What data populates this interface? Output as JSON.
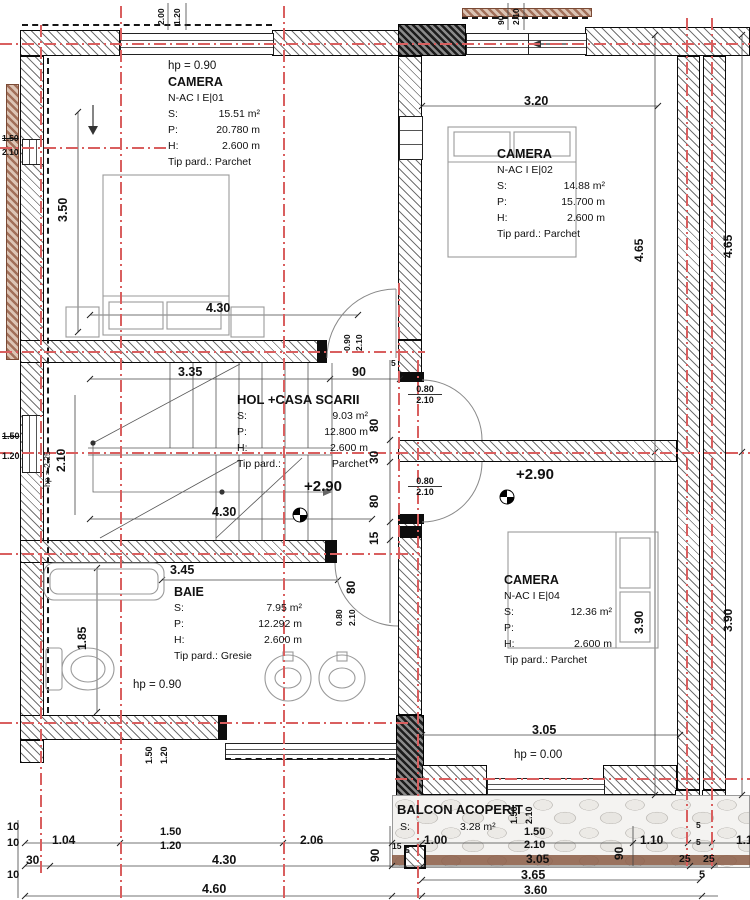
{
  "rooms": {
    "camera1": {
      "hp": "hp = 0.90",
      "name": "CAMERA",
      "code": "N-AC I E|01",
      "s_label": "S:",
      "s": "15.51 m²",
      "p_label": "P:",
      "p": "20.780 m",
      "h_label": "H:",
      "h": "2.600 m",
      "floor": "Tip pard.: Parchet"
    },
    "camera2": {
      "name": "CAMERA",
      "code": "N-AC I E|02",
      "s_label": "S:",
      "s": "14.88 m²",
      "p_label": "P:",
      "p": "15.700 m",
      "h_label": "H:",
      "h": "2.600 m",
      "floor": "Tip pard.: Parchet"
    },
    "hol": {
      "name": "HOL +CASA SCARII",
      "s_label": "S:",
      "s": "9.03 m²",
      "p_label": "P:",
      "p": "12.800 m",
      "h_label": "H:",
      "h": "2.600 m",
      "tip_label": "Tip pard.:",
      "floor": "Parchet",
      "level": "+2.90"
    },
    "baie": {
      "name": "BAIE",
      "s_label": "S:",
      "s": "7.95 m²",
      "p_label": "P:",
      "p": "12.292 m",
      "h_label": "H:",
      "h": "2.600 m",
      "floor": "Tip pard.: Gresie",
      "hp": "hp = 0.90"
    },
    "camera4": {
      "name": "CAMERA",
      "code": "N-AC I E|04",
      "s_label": "S:",
      "s": "12.36 m²",
      "p_label": "P:",
      "p": "14.220 m",
      "h_label": "H:",
      "h": "2.600 m",
      "floor": "Tip pard.: Parchet",
      "level": "+2.90"
    },
    "balcon": {
      "name": "BALCON ACOPERIT",
      "s_label": "S:",
      "s": "3.28 m²"
    }
  },
  "dims": {
    "w1_w": "2.00",
    "w1_h": "1.20",
    "entry_w": "90",
    "entry_h": "2.10",
    "room2_w": "3.20",
    "left_win_w": "1.50",
    "left_win_h": "2.10",
    "room1_h": "3.50",
    "r_col1_top": "4.65",
    "r_col2_top": "4.65",
    "r_col1_bot": "3.90",
    "r_col2_bot": "3.90",
    "room1_w": "4.30",
    "d1_w": "0.90",
    "d1_h": "2.10",
    "stair_w": "3.35",
    "d1_90": "90",
    "s5a": "5",
    "ch80a": "80",
    "ch30": "30",
    "ch80b": "80",
    "ch15": "15",
    "ch80c": "80",
    "d2_w": "0.80",
    "d2_h": "2.10",
    "d3_w": "0.80",
    "d3_h": "2.10",
    "d4_w": "0.80",
    "d4_h": "2.10",
    "stair_h": "2.10",
    "stair_hp": "hp = 2.25",
    "w3_w": "1.50",
    "w3_h": "1.20",
    "hall_w": "4.30",
    "baie_w": "3.45",
    "baie_h": "1.85",
    "w4_w": "1.50",
    "w4_h": "1.20",
    "r4_w": "3.05",
    "r4_hp": "hp = 0.00",
    "w5_w": "1.50",
    "w5_h": "2.10",
    "bal_90a": "90",
    "bal_15": "15",
    "bal_5a": "5",
    "bal_100": "1.00",
    "bal_150": "1.50",
    "bal_210": "2.10",
    "bal_305": "3.05",
    "bal_365": "3.65",
    "bal_360": "3.60",
    "bal_90b": "90",
    "bal_110": "1.10",
    "bal_25a": "25",
    "bal_25b": "25",
    "bal_5b": "5",
    "bal_5c": "5",
    "bal_5d": "5",
    "bal_11": "1.1",
    "bl_10a": "10",
    "bl_104": "1.04",
    "bl_150": "1.50",
    "bl_120": "1.20",
    "bl_206": "2.06",
    "bl_10b": "10",
    "bl_30": "30",
    "bl_430": "4.30",
    "bl_10c": "10",
    "bl_460": "4.60"
  }
}
